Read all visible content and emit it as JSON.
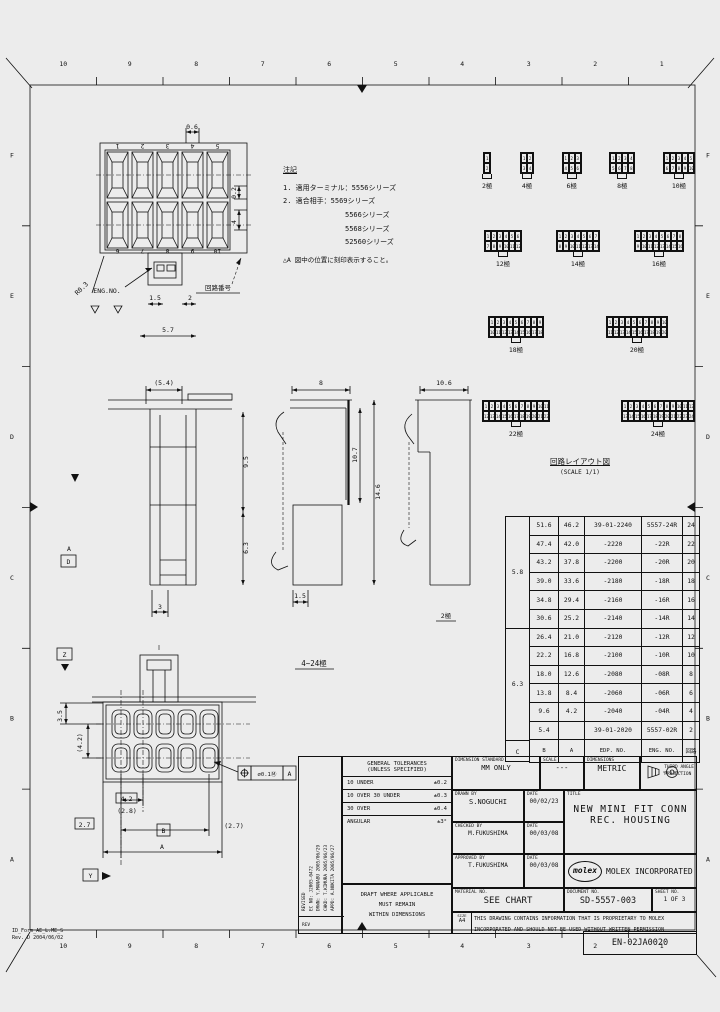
{
  "sheet": {
    "grid_top": [
      "10",
      "9",
      "8",
      "7",
      "6",
      "5",
      "4",
      "3",
      "2",
      "1"
    ],
    "grid_bottom": [
      "10",
      "9",
      "8",
      "7",
      "6",
      "5",
      "4",
      "3",
      "2",
      "1"
    ],
    "grid_left": [
      "F",
      "E",
      "D",
      "C",
      "B",
      "A"
    ],
    "grid_right": [
      "F",
      "E",
      "D",
      "C",
      "B",
      "A"
    ],
    "form_id": "ID_Form_AE_L.ME_S",
    "form_rev": "Rev. D 2004/06/02",
    "doc_code": "EN-02JA0020"
  },
  "notes": {
    "title": "注記",
    "line1": "1. 適用ターミナル：5556シリーズ",
    "line2": "2. 適合相手：5569シリーズ",
    "line3": "5566シリーズ",
    "line4": "5568シリーズ",
    "line5": "52560シリーズ",
    "note_a": "△A 図中の位置に刻印表示すること。"
  },
  "top_view": {
    "dim_top": "0.6",
    "dim_right": "0.2",
    "dim_right2": "4",
    "dim_latch1": "1.5",
    "dim_latch2": "2",
    "dim_bottom": "5.7",
    "radius": "R0.3",
    "label_eng_no": "ENG.NO.",
    "label_circuit_no": "回路番号",
    "numbers_top": [
      "1",
      "2",
      "3",
      "4",
      "5"
    ],
    "numbers_bottom": [
      "6",
      "7",
      "8",
      "9",
      "10"
    ]
  },
  "sections": {
    "v1_top": "(5.4)",
    "v1_h1": "9.5",
    "v1_h2": "6.3",
    "v1_bottom": "3",
    "v2_top": "8",
    "v2_h1": "10.7",
    "v2_h2": "14.6",
    "v2_bottom": "1.5",
    "v3_top": "10.6",
    "v3_label": "2極"
  },
  "front_view": {
    "label": "4~24極",
    "dim_v1": "3.5",
    "dim_v2": "(4.2)",
    "dim_pitch": "4.2",
    "dim_pitch2": "(2.8)",
    "dim_left": "2.7",
    "dim_b": "B",
    "dim_right": "(2.7)",
    "dim_a": "A",
    "datum_z": "Z",
    "datum_y": "Y",
    "datum_d": "D",
    "datum_a": "A",
    "tol_dia": "⌀0.1Ⓜ",
    "tol_datum": "A"
  },
  "circuit_layout": {
    "title": "回路レイアウト図",
    "scale": "(SCALE 1/1)",
    "items": [
      {
        "label": "2極",
        "cols": 1
      },
      {
        "label": "4極",
        "cols": 2
      },
      {
        "label": "6極",
        "cols": 3
      },
      {
        "label": "8極",
        "cols": 4
      },
      {
        "label": "10極",
        "cols": 5
      },
      {
        "label": "12極",
        "cols": 6
      },
      {
        "label": "14極",
        "cols": 7
      },
      {
        "label": "16極",
        "cols": 8
      },
      {
        "label": "18極",
        "cols": 9
      },
      {
        "label": "20極",
        "cols": 10
      },
      {
        "label": "22極",
        "cols": 11
      },
      {
        "label": "24極",
        "cols": 12
      }
    ]
  },
  "parts_table": {
    "header_c": "C",
    "header_b": "B",
    "header_a": "A",
    "header_edp": "EDP. NO.",
    "header_eng": "ENG. NO.",
    "header_ckt": "回路",
    "group_c": [
      "5.8",
      "6.3"
    ],
    "rows": [
      {
        "b": "51.6",
        "a": "46.2",
        "edp": "39-01-2240",
        "eng": "5557-24R",
        "ckt": "24"
      },
      {
        "b": "47.4",
        "a": "42.0",
        "edp": "-2220",
        "eng": "-22R",
        "ckt": "22"
      },
      {
        "b": "43.2",
        "a": "37.8",
        "edp": "-2200",
        "eng": "-20R",
        "ckt": "20"
      },
      {
        "b": "39.0",
        "a": "33.6",
        "edp": "-2180",
        "eng": "-18R",
        "ckt": "18"
      },
      {
        "b": "34.8",
        "a": "29.4",
        "edp": "-2160",
        "eng": "-16R",
        "ckt": "16"
      },
      {
        "b": "30.6",
        "a": "25.2",
        "edp": "-2140",
        "eng": "-14R",
        "ckt": "14"
      },
      {
        "b": "26.4",
        "a": "21.0",
        "edp": "-2120",
        "eng": "-12R",
        "ckt": "12"
      },
      {
        "b": "22.2",
        "a": "16.8",
        "edp": "-2100",
        "eng": "-10R",
        "ckt": "10"
      },
      {
        "b": "18.0",
        "a": "12.6",
        "edp": "-2080",
        "eng": "-08R",
        "ckt": "8"
      },
      {
        "b": "13.8",
        "a": "8.4",
        "edp": "-2060",
        "eng": "-06R",
        "ckt": "6"
      },
      {
        "b": "9.6",
        "a": "4.2",
        "edp": "-2040",
        "eng": "-04R",
        "ckt": "4"
      },
      {
        "b": "5.4",
        "a": "",
        "edp": "39-01-2020",
        "eng": "5557-02R",
        "ckt": "2"
      }
    ]
  },
  "tolerances": {
    "title1": "GENERAL TOLERANCES",
    "title2": "(UNLESS SPECIFIED)",
    "rows": [
      {
        "range": "10 UNDER",
        "tol": "±0.2"
      },
      {
        "range": "10 OVER 30 UNDER",
        "tol": "±0.3"
      },
      {
        "range": "30 OVER",
        "tol": "±0.4"
      },
      {
        "range": "ANGULAR",
        "tol": "±3°"
      }
    ],
    "note1": "DRAFT WHERE APPLICABLE",
    "note2": "MUST REMAIN",
    "note3": "WITHIN DIMENSIONS"
  },
  "title_block": {
    "dim_standard_label": "DIMENSION STANDARD",
    "dim_standard": "MM ONLY",
    "scale_label": "SCALE",
    "scale": "---",
    "dims_label": "DIMENSIONS",
    "dims": "METRIC",
    "projection1": "THIRD ANGLE",
    "projection2": "PROJECTION",
    "drawn_label": "DRAWN BY",
    "drawn": "S.NOGUCHI",
    "date_label": "DATE",
    "drawn_date": "00/02/23",
    "checked_label": "CHECKED BY",
    "checked": "M.FUKUSHIMA",
    "checked_date": "00/03/08",
    "approved_label": "APPROVED BY",
    "approved": "T.FUKUSHIMA",
    "approved_date": "00/03/08",
    "title_label": "TITLE",
    "title1": "NEW MINI FIT CONN",
    "title2": "REC. HOUSING",
    "logo": "molex",
    "company": "MOLEX INCORPORATED",
    "material_label": "MATERIAL NO.",
    "material": "SEE CHART",
    "document_label": "DOCUMENT NO.",
    "document": "SD-5557-003",
    "sheet_label": "SHEET NO.",
    "sheet": "1 OF 3",
    "size_label": "SIZE",
    "size": "A4",
    "disclaimer1": "THIS DRAWING CONTAINS INFORMATION THAT IS PROPRIETARY TO MOLEX",
    "disclaimer2": "INCORPORATED AND SHOULD NOT BE USED WITHOUT WRITTEN PERMISSION"
  },
  "revision": {
    "lines": [
      "REVISED",
      "EC NO: J2005-0472",
      "DRWN: Y.MANABU 2005/06/29",
      "CHKD: T.KIMURA 2005/06/23",
      "APPD: A.NUKITA 2005/06/27"
    ],
    "rev_label": "REV"
  }
}
